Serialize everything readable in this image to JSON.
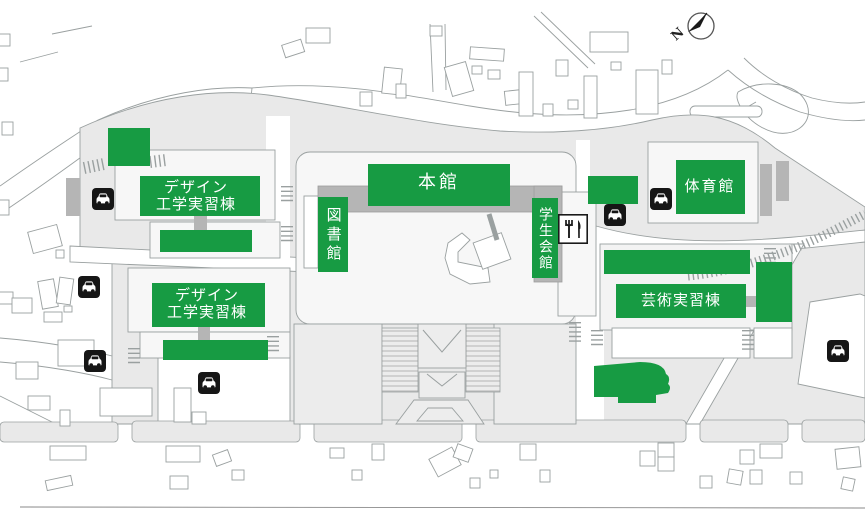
{
  "map": {
    "compass": {
      "label": "N"
    },
    "labels": {
      "honkan": "本館",
      "toshokan": "図書館",
      "gakusei_kaikan": "学生会館",
      "taiikukan": "体育館",
      "design_line1": "デザイン",
      "design_line2": "工学実習棟",
      "geijutsu": "芸術実習棟"
    },
    "icons": {
      "parking": "car-parking-icon",
      "restaurant": "fork-knife-icon",
      "compass": "north-arrow-icon"
    },
    "colors": {
      "highlight_green": "#179b43",
      "ground_gray": "#e9e9e9",
      "structure_gray": "#b5b5b5",
      "icon_black": "#161616",
      "outline_gray": "#9aa0a0"
    }
  }
}
